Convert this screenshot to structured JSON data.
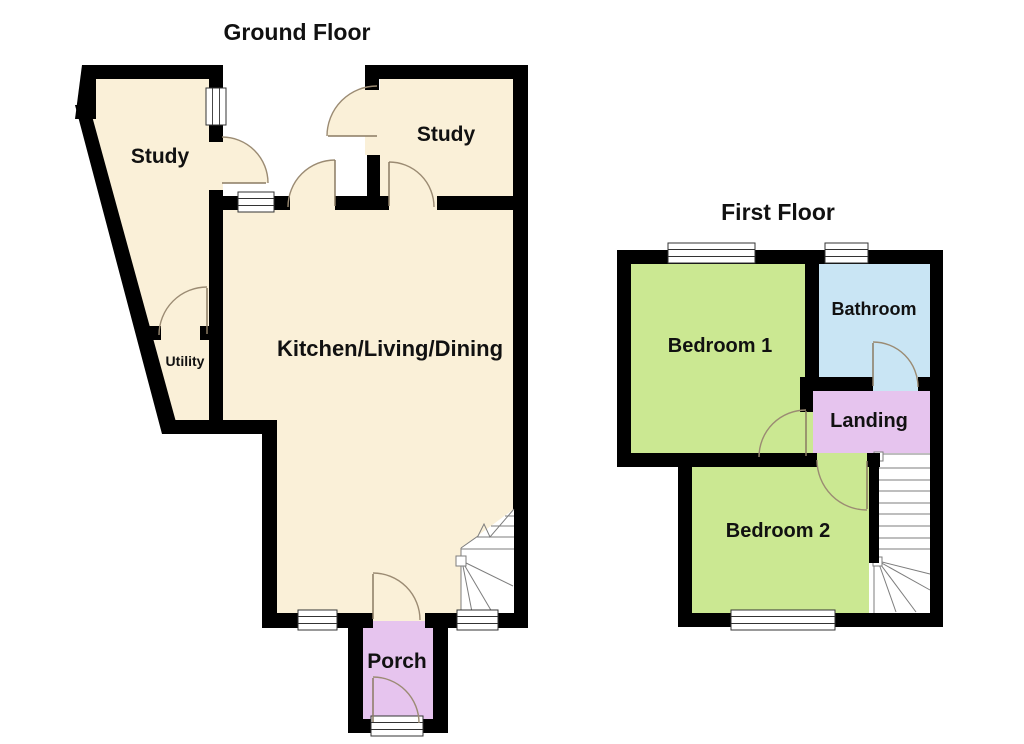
{
  "image": {
    "type": "floorplan"
  },
  "colors": {
    "background": "#ffffff",
    "wall": "#000000",
    "floor_cream": "#faf0d8",
    "room_green": "#cbe892",
    "room_blue": "#c9e5f4",
    "room_purple": "#e6c4ee",
    "door_arc": "#9b8b73",
    "stair_line": "#7d7d7d",
    "window_frame": "#333333",
    "label_text": "#111111"
  },
  "floors": {
    "ground": {
      "title": "Ground Floor",
      "rooms": {
        "study_left": "Study",
        "study_right": "Study",
        "kitchen": "Kitchen/Living/Dining",
        "utility": "Utility",
        "porch": "Porch"
      }
    },
    "first": {
      "title": "First Floor",
      "rooms": {
        "bedroom1": "Bedroom 1",
        "bathroom": "Bathroom",
        "landing": "Landing",
        "bedroom2": "Bedroom 2"
      }
    }
  }
}
